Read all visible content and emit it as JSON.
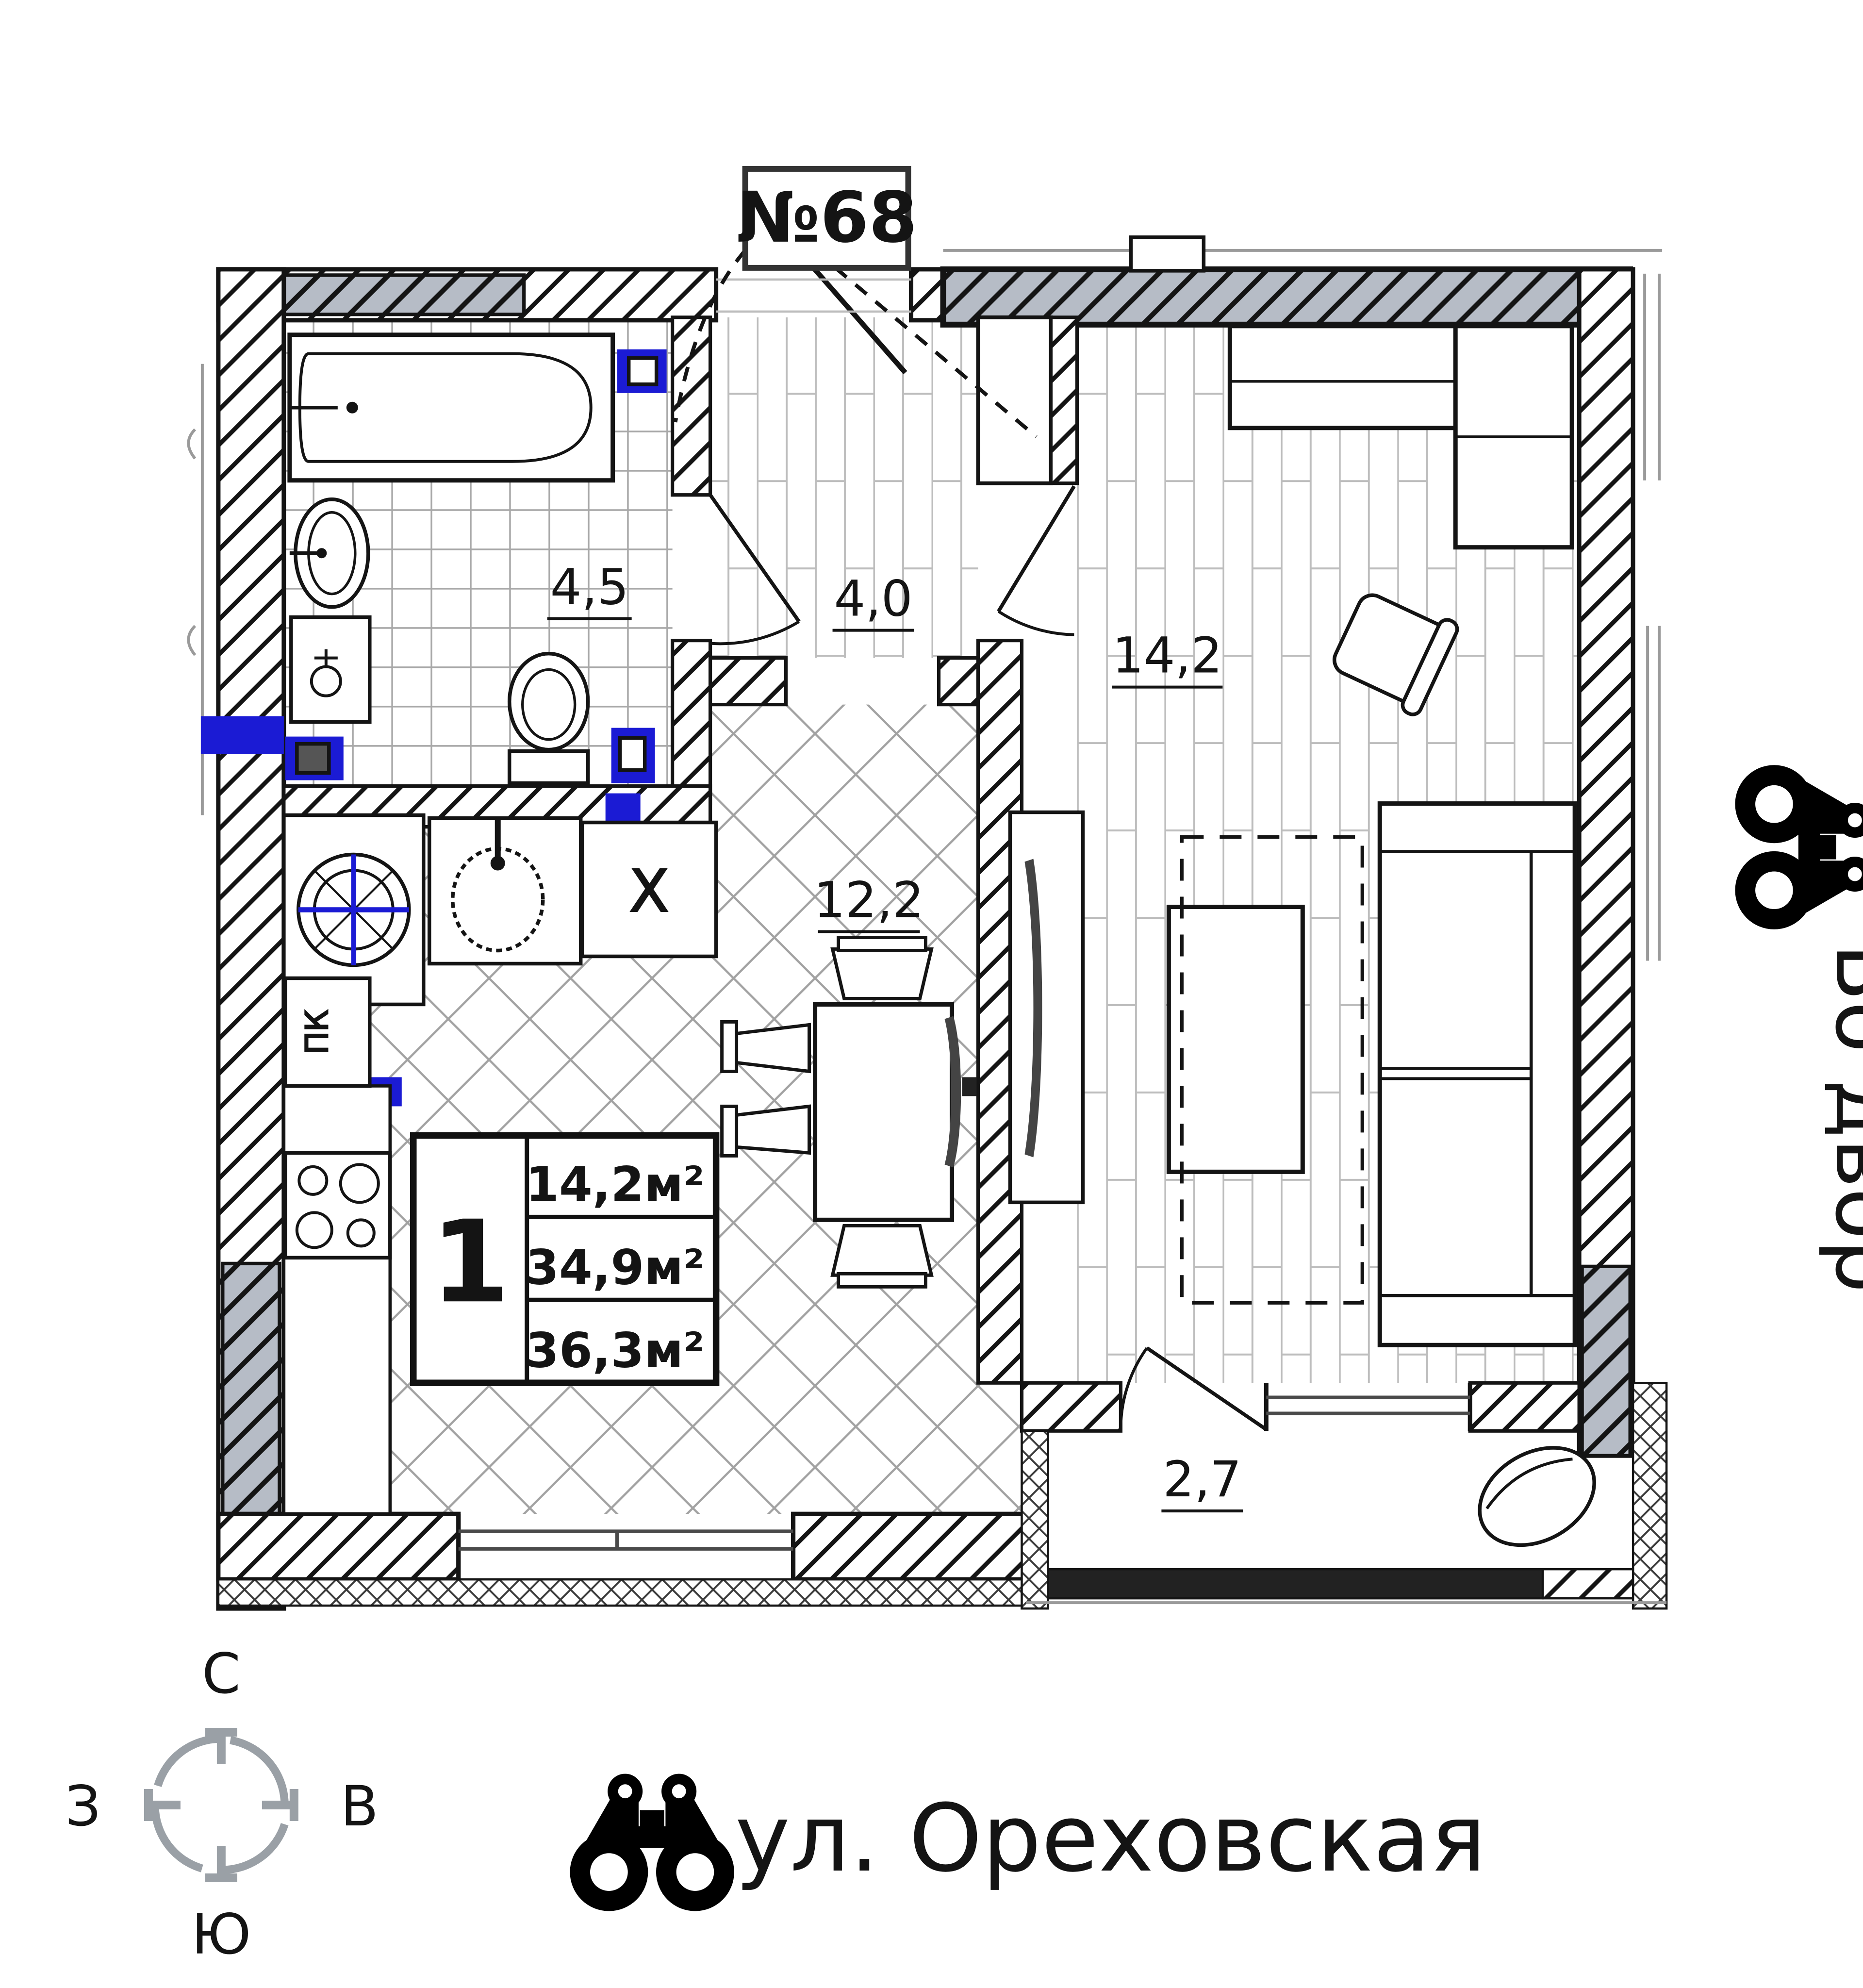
{
  "title_box": {
    "apartment_number": "№68"
  },
  "rooms": {
    "bathroom": {
      "name": "bathroom",
      "area": "4,5"
    },
    "hallway": {
      "name": "hallway",
      "area": "4,0"
    },
    "living_room": {
      "name": "living-room",
      "area": "14,2"
    },
    "kitchen": {
      "name": "kitchen",
      "area": "12,2"
    },
    "balcony": {
      "name": "balcony",
      "area": "2,7"
    }
  },
  "info_box": {
    "room_count": "1",
    "living_area": "14,2м²",
    "area_no_balcony": "34,9м²",
    "total_area": "36,3м²"
  },
  "appliance_labels": {
    "fridge": "X",
    "fire_cabinet": "ПК"
  },
  "compass": {
    "north": "С",
    "east": "В",
    "south": "Ю",
    "west": "З"
  },
  "annotations": {
    "street_name": "ул. Ореховская",
    "courtyard": "Во двор"
  },
  "colors": {
    "wall_gray": "#b6bcc6",
    "plumbing_blue": "#1b1bd4",
    "compass_gray": "#9aa0a6",
    "line_black": "#141414"
  }
}
